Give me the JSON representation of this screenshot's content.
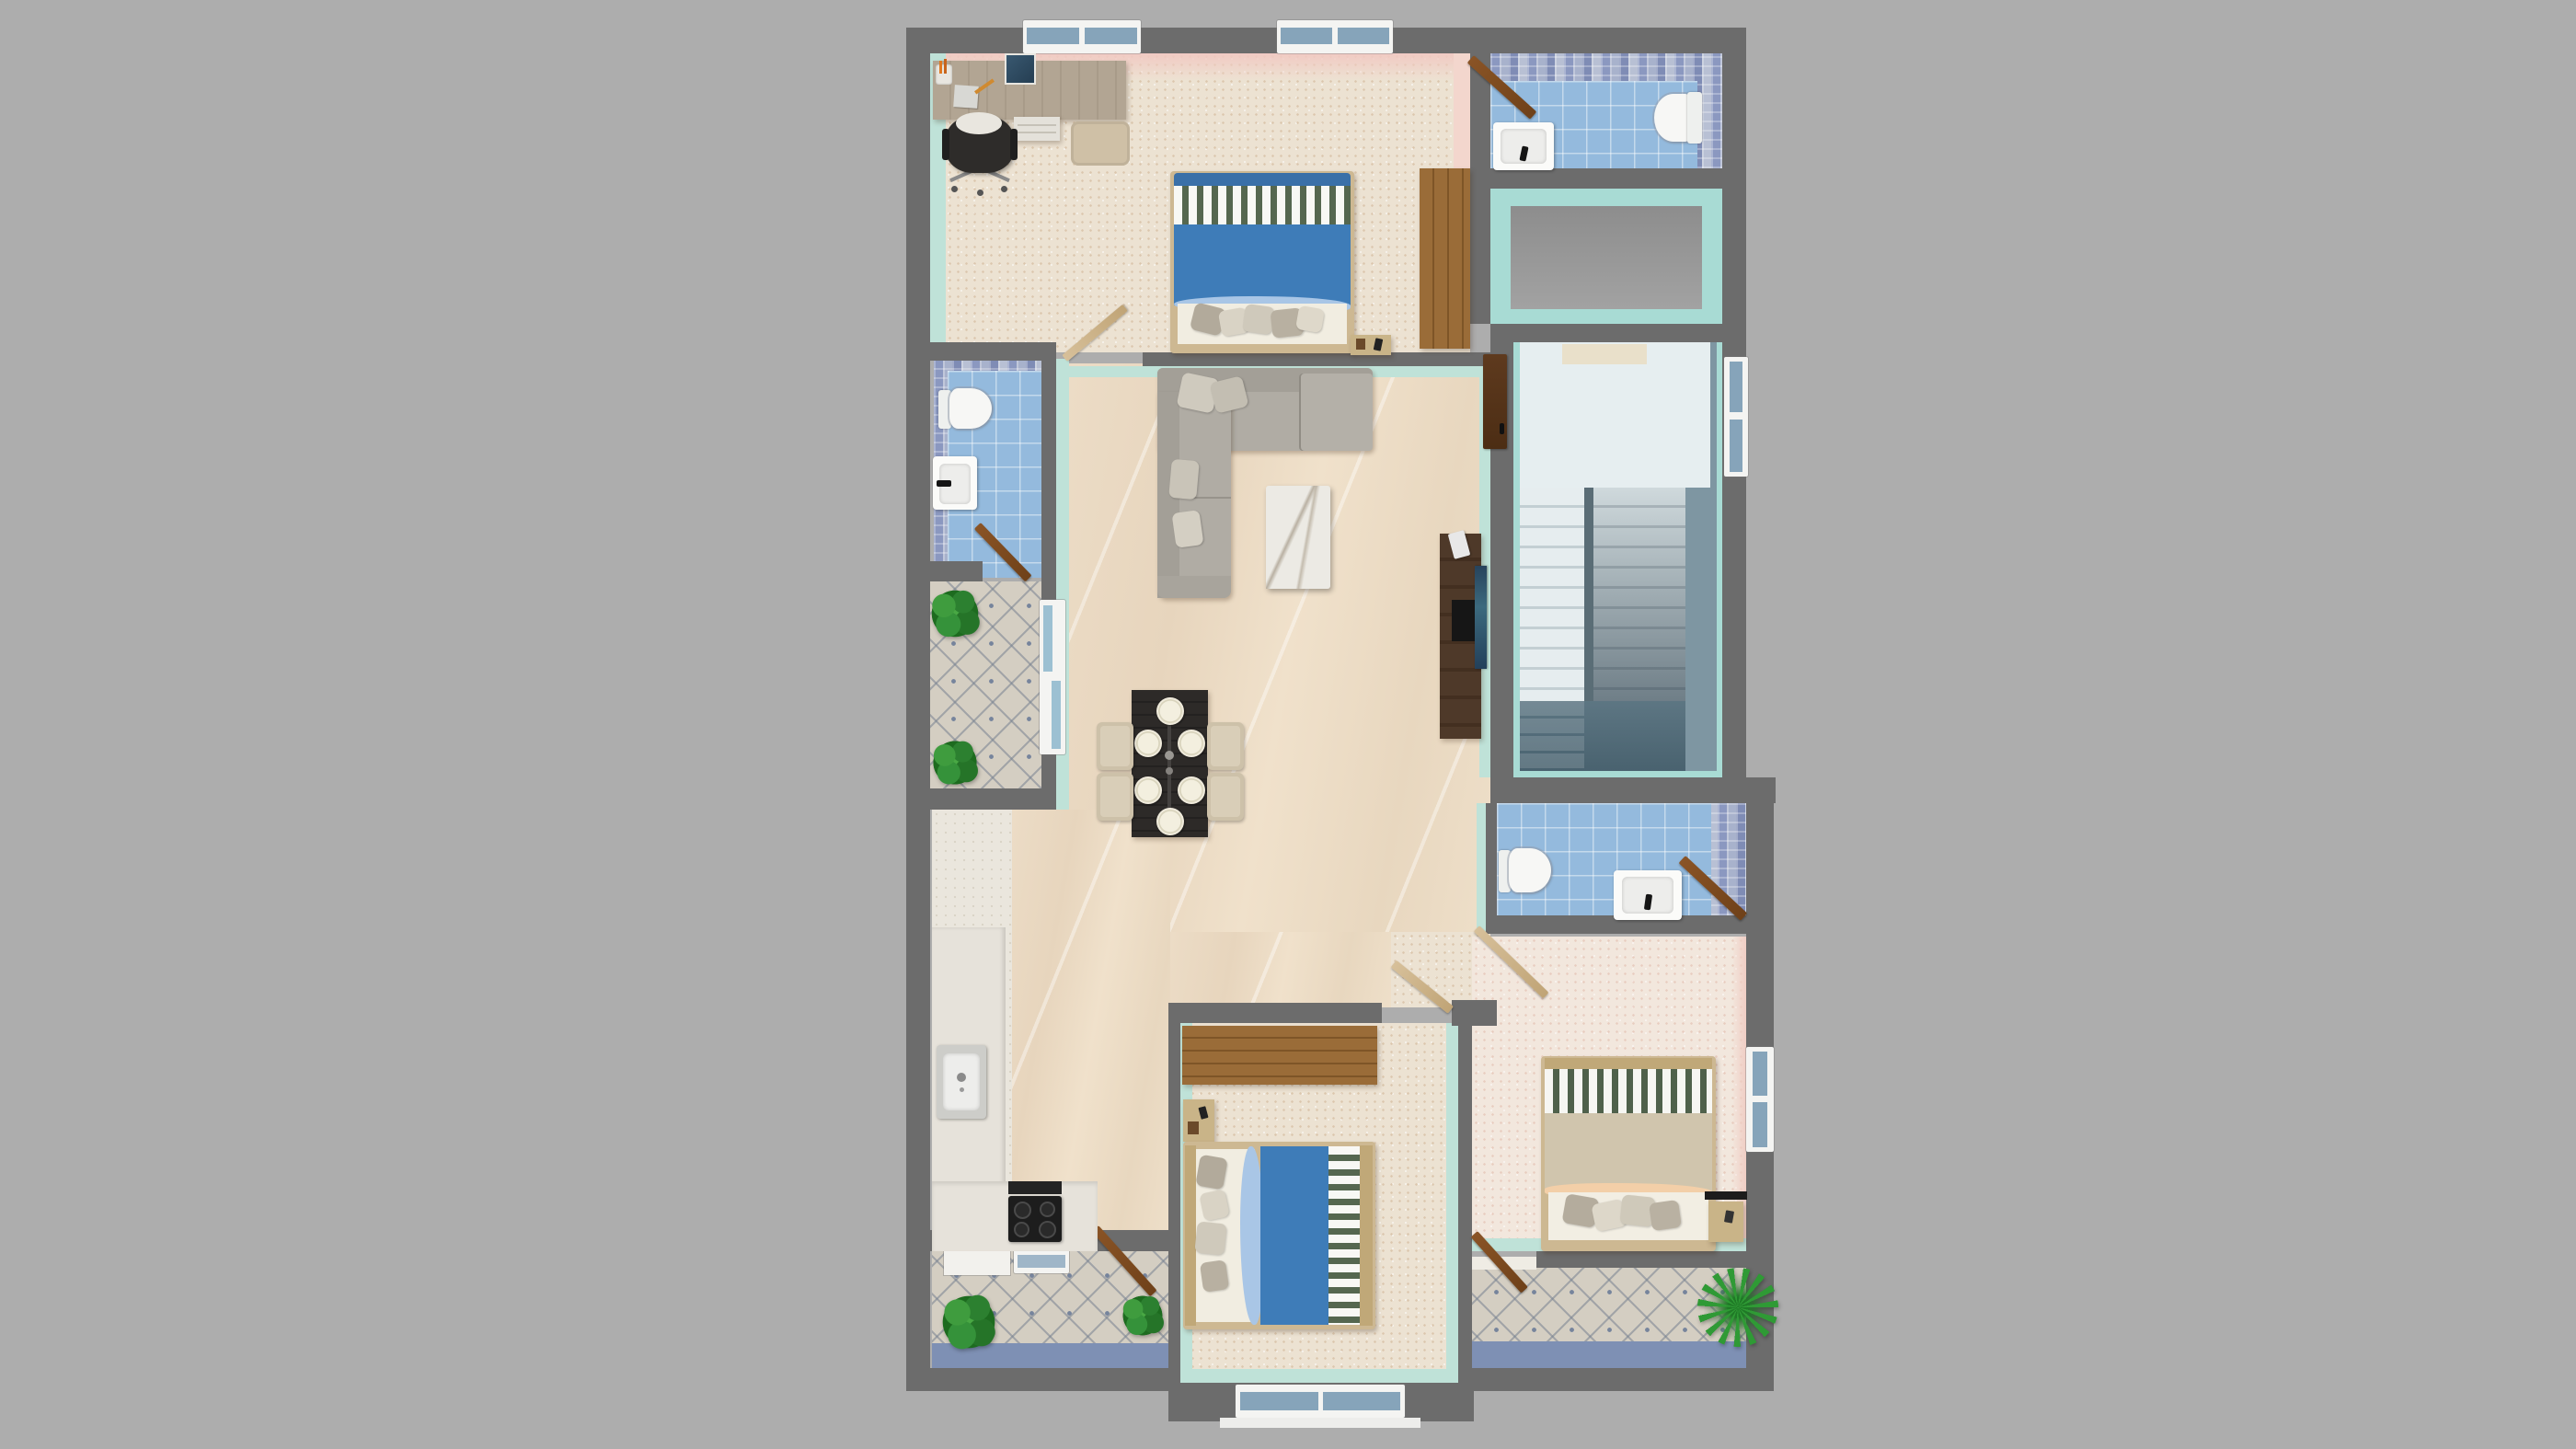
{
  "scene": {
    "type": "3d-floorplan-render",
    "view": "top-down",
    "description": "Photoreal top-down 3D render of a two-bedroom-plus-office apartment floor plan on a plain gray backdrop. No visible text anywhere in the image.",
    "background_color": "#adadad"
  },
  "palette": {
    "bg": "#adadad",
    "wall": "#6c6c6c",
    "wall2": "#5f5f5f",
    "floor_cream": "#ece2d2",
    "floor_pink": "#f2e7dd",
    "floor_white": "#eae6dd",
    "marble": "#ecdcc6",
    "tile_blue": "#94badd",
    "mosaic": "#97a3c4",
    "diamond": "#d4cec2",
    "mint": "#bfe2d8",
    "teal": "#a8dbd4",
    "pink": "#f1c9c2",
    "bed_blue": "#3e7cb8",
    "bed_blue_lt": "#a9c6e6",
    "stripe_green": "#55674f",
    "wood": "#96682f",
    "wood_dark": "#4e3929",
    "door": "#7a4a20",
    "door_tan": "#d2ba8e",
    "sofa": "#b0aca4",
    "sofa_dk": "#a39f97",
    "stair_light": "#e6eef0",
    "stair_dark": "#49626f",
    "slate": "#7e96a2",
    "balcony_edge": "#7e90b4",
    "plant": "#2e8f31",
    "table_dark": "#2d2a28",
    "frame_tan": "#cdb892"
  },
  "rooms": [
    {
      "id": "bedroom-office",
      "area": "top-left",
      "features": [
        "desk",
        "office-chair",
        "stool",
        "drawer-unit",
        "double-bed-blue",
        "wardrobe",
        "nightstand",
        "two-windows"
      ]
    },
    {
      "id": "bathroom-top",
      "area": "top-right",
      "features": [
        "toilet",
        "sink",
        "blue-tile-floor",
        "mosaic-walls",
        "door"
      ]
    },
    {
      "id": "shaft-void",
      "area": "right-upper",
      "features": [
        "teal-walls",
        "gray-floor"
      ]
    },
    {
      "id": "staircase",
      "area": "right-middle",
      "features": [
        "landing",
        "two-flights",
        "window"
      ]
    },
    {
      "id": "living-dining",
      "area": "center",
      "features": [
        "l-shaped-sofa",
        "marble-coffee-table",
        "tv-unit",
        "dining-table-6-plates",
        "4-chairs"
      ]
    },
    {
      "id": "bathroom-left",
      "area": "middle-left",
      "features": [
        "toilet",
        "sink",
        "blue-tile-floor",
        "door"
      ]
    },
    {
      "id": "balcony-left",
      "area": "middle-left",
      "features": [
        "diamond-tile-floor",
        "two-plants",
        "sliding-door"
      ]
    },
    {
      "id": "kitchen",
      "area": "bottom-left",
      "features": [
        "l-counter",
        "sink",
        "cooktop-4-burners",
        "vent"
      ]
    },
    {
      "id": "balcony-bottom-left",
      "area": "bottom-left",
      "features": [
        "diamond-tile-floor",
        "two-plants",
        "door",
        "window"
      ]
    },
    {
      "id": "bedroom-2",
      "area": "bottom-center",
      "features": [
        "double-bed-blue",
        "wardrobe",
        "nightstand",
        "window"
      ]
    },
    {
      "id": "bathroom-right",
      "area": "center-right",
      "features": [
        "toilet",
        "sink",
        "blue-tile-floor",
        "door"
      ]
    },
    {
      "id": "bedroom-3",
      "area": "bottom-right",
      "features": [
        "double-bed-tan",
        "nightstand",
        "window",
        "pink-walls"
      ]
    },
    {
      "id": "balcony-bottom-right",
      "area": "bottom-right",
      "features": [
        "diamond-tile-floor",
        "palm-plant",
        "door"
      ]
    }
  ]
}
